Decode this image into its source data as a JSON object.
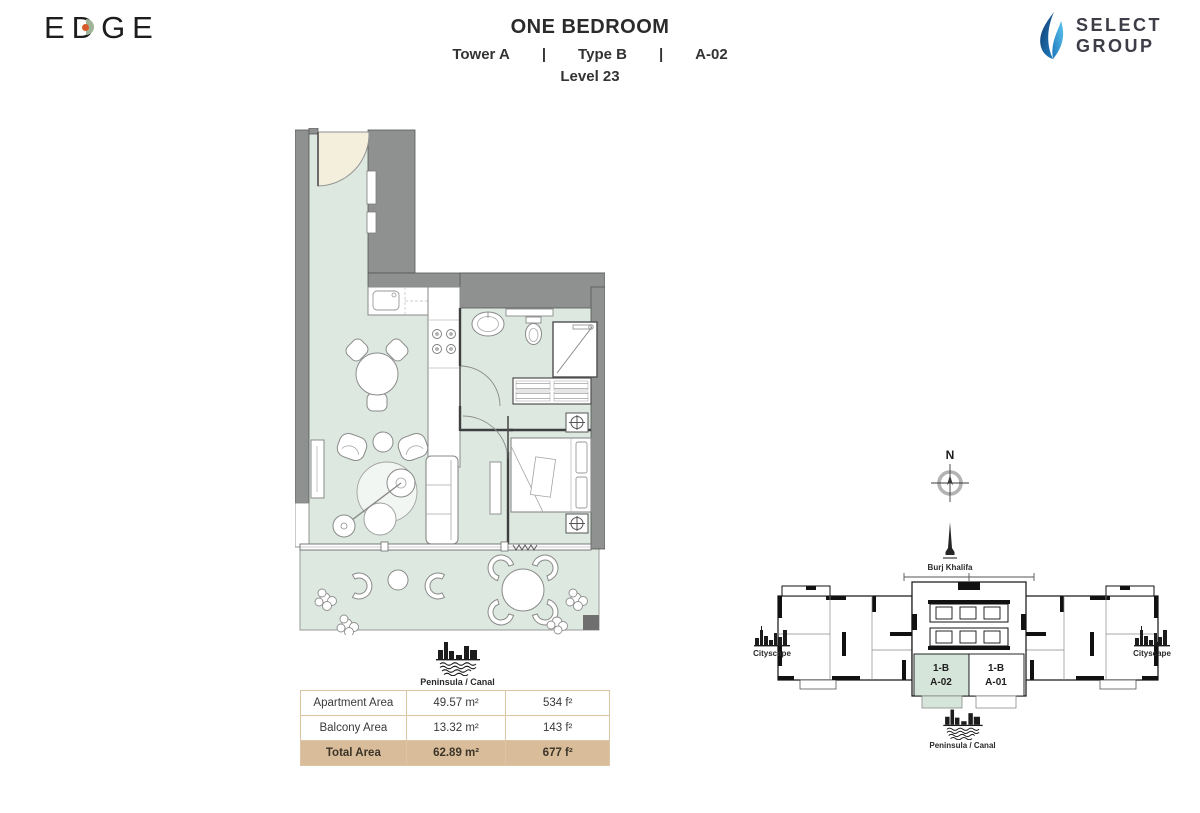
{
  "header": {
    "brand": "EDGE",
    "title": "ONE BEDROOM",
    "tower": "Tower A",
    "sep": "|",
    "type_label": "Type B",
    "unit": "A-02",
    "level": "Level 23",
    "select_line1": "SELECT",
    "select_line2": "GROUP"
  },
  "floor_plan": {
    "view_label": "Peninsula / Canal"
  },
  "area_table": {
    "rows": [
      {
        "label": "Apartment Area",
        "metric": "49.57 m²",
        "imperial": "534 f²"
      },
      {
        "label": "Balcony Area",
        "metric": "13.32 m²",
        "imperial": "143 f²"
      },
      {
        "label": "Total Area",
        "metric": "62.89 m²",
        "imperial": "677 f²"
      }
    ]
  },
  "key_plan": {
    "compass_label": "N",
    "landmark_top": "Burj Khalifa",
    "landmark_left": "Cityscape",
    "landmark_right": "Cityscape",
    "landmark_bottom": "Peninsula / Canal",
    "units": [
      {
        "line1": "1-B",
        "line2": "A-02",
        "highlighted": true
      },
      {
        "line1": "1-B",
        "line2": "A-01",
        "highlighted": false
      }
    ]
  },
  "colors": {
    "floor_green": "#dce8e0",
    "keyplan_green": "#d6e5da",
    "wall_gray": "#8f9191",
    "door_beige": "#f4eedd",
    "table_total_bg": "#d9bd9a",
    "table_border": "#dcc5a4",
    "select_blue_dark": "#1b4f8d",
    "select_blue_light": "#2aa9e0",
    "edge_green": "#9fb497",
    "edge_orange": "#d85a2a"
  }
}
